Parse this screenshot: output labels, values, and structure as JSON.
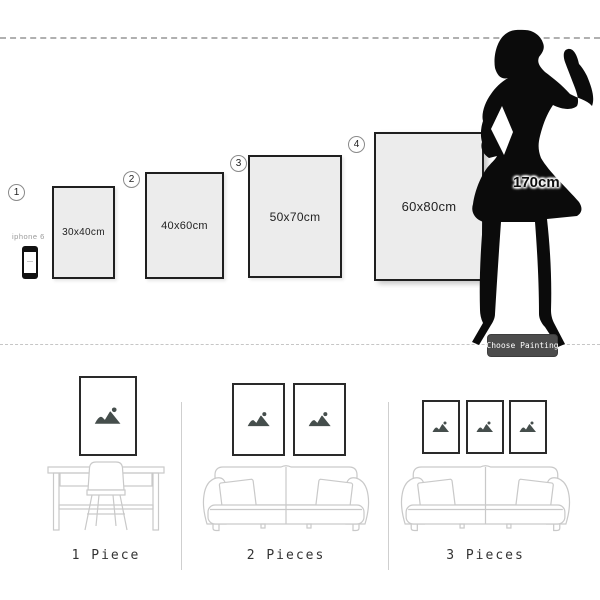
{
  "top": {
    "options": [
      {
        "number": "1",
        "size": "30x40cm"
      },
      {
        "number": "2",
        "size": "40x60cm"
      },
      {
        "number": "3",
        "size": "50x70cm"
      },
      {
        "number": "4",
        "size": "60x80cm"
      }
    ],
    "phone": {
      "label": "iphone 6"
    },
    "figure": {
      "height": "170cm"
    },
    "button": {
      "label": "Choose Painting"
    }
  },
  "scenes": [
    {
      "label": "1 Piece",
      "frame_count": 1
    },
    {
      "label": "2 Pieces",
      "frame_count": 2
    },
    {
      "label": "3 Pieces",
      "frame_count": 3
    }
  ],
  "icons": {
    "frame_art": "image-placeholder-icon"
  },
  "colors": {
    "frame_fill": "#ececec",
    "frame_border": "#1f1f1f",
    "silhouette": "#0b0b0b",
    "button_bg": "#4c4c4c",
    "button_text": "#ffffff",
    "line_art": "#c9c9c9",
    "placeholder_icon": "#454e4c",
    "dashed_line": "#b0b0b0",
    "muted_text": "#9a9a9a"
  }
}
